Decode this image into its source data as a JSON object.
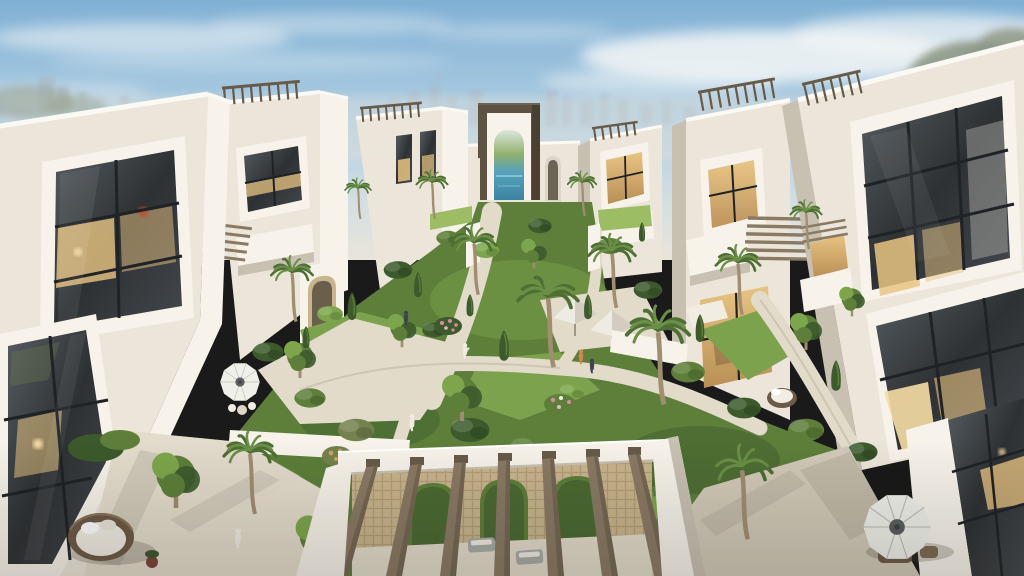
{
  "scene": {
    "type": "architectural-render",
    "description": "Aerial dusk view of a luxury white villa community: two rows of modern Arabic-style townhouses with rooftop pergolas and glowing interiors flank a lush central garden courtyard with palm trees, lawns and winding paths, leading to a dark bronze gateway pavilion with a swimming pool behind it; a city skyline sits on the hazy horizon; in the foreground a white pergola with carved lattice screens, a round wicker daybed and patio umbrellas on the terraces.",
    "setting": "residential compound courtyard",
    "time_of_day": "dusk",
    "lighting": "soft warm low sun with lit interior windows",
    "objects": [
      "white-villas",
      "rooftop-pergolas",
      "gateway-pavilion",
      "swimming-pool",
      "central-garden-courtyard",
      "palm-trees",
      "cypress-shrubs",
      "lawn-patches",
      "garden-paths",
      "walkway-canopies",
      "patio-umbrellas",
      "wicker-daybed",
      "wicker-sofa",
      "foreground-pergola",
      "mashrabiya-lattice-screens",
      "residents-walking",
      "city-skyline",
      "clouds"
    ],
    "people_visible": "several small figures walking on the garden paths"
  },
  "palette": {
    "sky-top": "#7fb0d4",
    "sky-mid": "#aecde2",
    "sky-low": "#d3dfe2",
    "sky-horizon": "#e9e5da",
    "cloud": "#f5f7f7",
    "skyline": "#a9bac9",
    "haze-olive": "#8e9886",
    "wall-bright": "#f7f3ea",
    "wall-light": "#ece6da",
    "wall-mid": "#ddd6c8",
    "wall-shadow": "#c8c1b2",
    "parapet": "#fbf9f3",
    "wood": "#8a7a64",
    "wood-dark": "#675a49",
    "wood-light": "#a8967c",
    "lattice": "#c9b58d",
    "lattice-dark": "#a08a62",
    "portal-dark": "#5e5343",
    "portal-deep": "#49402f",
    "glass-dark": "#2e3134",
    "glass-mid": "#555c60",
    "mullion": "#1f2326",
    "warm-glow": "#e8c482",
    "warm-bright": "#f6dda4",
    "lamp-red": "#c05030",
    "pool-sky": "#dce6dc",
    "pool-green": "#8fb06d",
    "pool-blue": "#55a2bc",
    "pool-deep": "#3c84a2",
    "lawn": "#7ca24d",
    "lawn-light": "#9cbd64",
    "green-dark": "#3c5a2c",
    "green-mid": "#5d7f3a",
    "green-bright": "#7da64c",
    "green-olive": "#74824e",
    "frond": "#6b8f46",
    "frond-dark": "#4e6f34",
    "trunk": "#a18e71",
    "path": "#e2dbc9",
    "terrace": "#e4ddcc",
    "terrace-shadow": "#d2cab8",
    "umbrella": "#eff0ea",
    "umbrella-center": "#5b5e60",
    "canopy-light": "#eeebe2",
    "canopy-shade": "#d2cdc0",
    "wicker": "#6d5a46",
    "cushion": "#f1ede3",
    "flower-pink": "#d98ca0",
    "flower-gold": "#c9a45c",
    "shadow": "#4a463c",
    "person-light": "#f0ece2",
    "person-dark": "#3a4450"
  }
}
